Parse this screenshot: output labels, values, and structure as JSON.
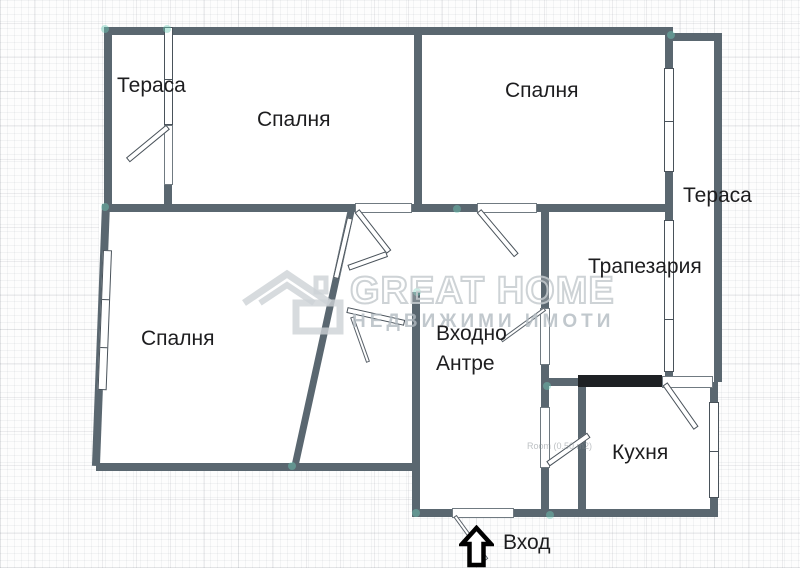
{
  "floor_plan": {
    "rooms": {
      "terrace_top_left": "Тераса",
      "bedroom_top": "Спалня",
      "bedroom_top_right": "Спалня",
      "terrace_right": "Тераса",
      "dining_room": "Трапезария",
      "bedroom_left": "Спалня",
      "entry_hall_line1": "Входно",
      "entry_hall_line2": "Антре",
      "kitchen": "Кухня"
    },
    "entrance_label": "Вход",
    "area_note": "Room (0.50 m2)",
    "watermark": {
      "brand": "GREAT HOME",
      "tagline": "НЕДВИЖИМИ ИМОТИ"
    },
    "colors": {
      "wall": "#5a6770",
      "snap_dot": "#6ecdb7",
      "label_text": "#1d1d1f",
      "watermark_gray": "#c5cbcf",
      "built_in_unit": "#1e2124"
    }
  }
}
